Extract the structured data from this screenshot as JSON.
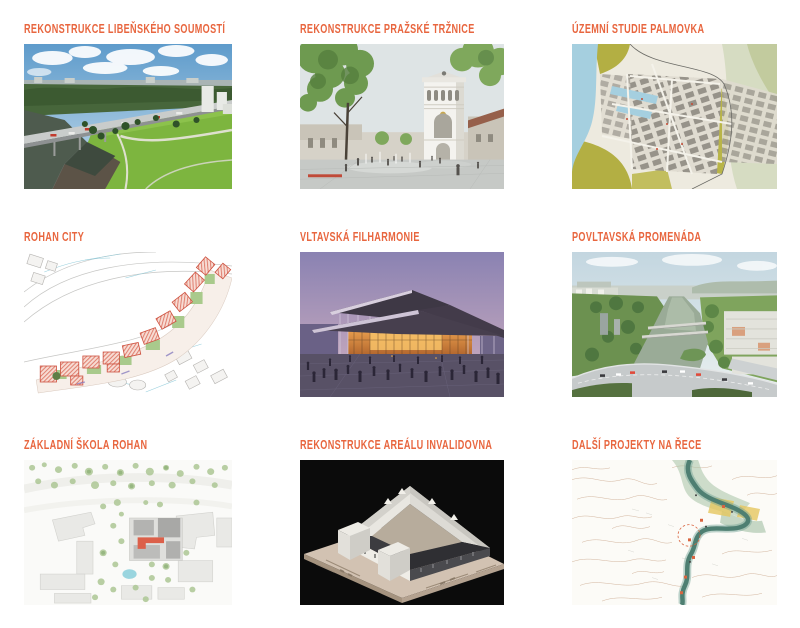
{
  "theme": {
    "accent_color": "#E8663F",
    "background_color": "#FFFFFF"
  },
  "projects": [
    {
      "title": "REKONSTRUKCE LIBEŇSKÉHO SOUMOSTÍ",
      "image": "aerial-photo-of-liben-bridge-over-river-with-green-park"
    },
    {
      "title": "REKONSTRUKCE PRAŽSKÉ TRŽNICE",
      "image": "render-of-prague-market-white-tower-and-plaza-with-trees"
    },
    {
      "title": "ÚZEMNÍ STUDIE PALMOVKA",
      "image": "urban-study-map-of-palmovka-with-river-and-parks"
    },
    {
      "title": "ROHAN CITY",
      "image": "masterplan-drawing-with-red-hatched-blocks-and-green-courtyards"
    },
    {
      "title": "VLTAVSKÁ FILHARMONIE",
      "image": "dusk-render-of-philharmonic-hall-with-glowing-facade-and-crowd"
    },
    {
      "title": "POVLTAVSKÁ PROMENÁDA",
      "image": "aerial-photo-of-vltava-river-bridges-and-foreground-highway"
    },
    {
      "title": "ZÁKLADNÍ ŠKOLA ROHAN",
      "image": "site-plan-of-school-with-gray-buildings-trees-and-red-highlight"
    },
    {
      "title": "REKONSTRUKCE AREÁLU INVALIDOVNA",
      "image": "physical-model-of-invalidovna-courtyard-complex-on-black"
    },
    {
      "title": "DALŠÍ PROJEKTY NA ŘECE",
      "image": "contour-map-of-prague-with-teal-river-and-yellow-highlights"
    }
  ]
}
